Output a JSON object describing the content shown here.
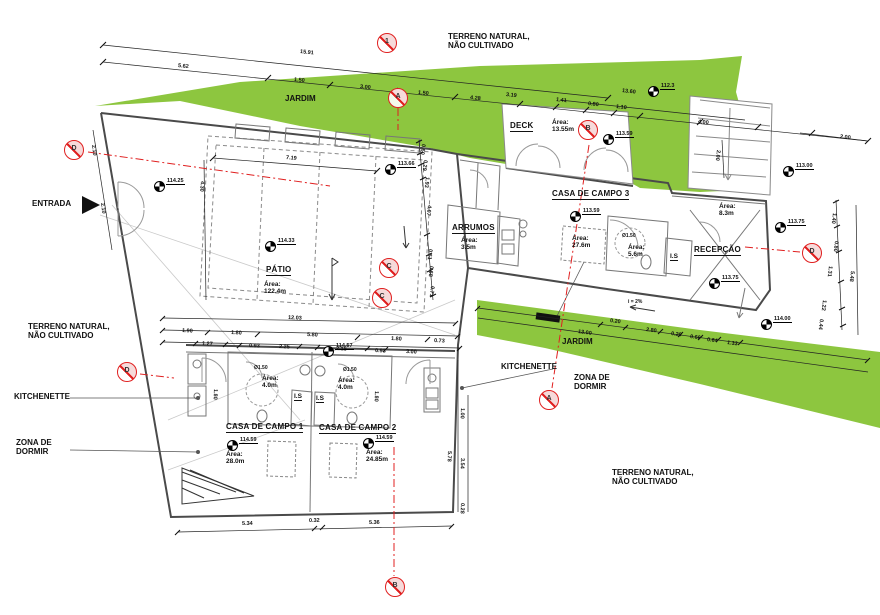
{
  "drawing": {
    "labels": {
      "terrain_top": "TERRENO NATURAL,\nNÃO CULTIVADO",
      "jardim_top": "JARDIM",
      "deck": "DECK",
      "casa3": "CASA DE CAMPO 3",
      "arrumos": "ARRUMOS",
      "recepcao": "RECEPÇÃO",
      "entrada": "ENTRADA",
      "patio": "PÁTIO",
      "terrain_left": "TERRENO NATURAL,\nNÃO CULTIVADO",
      "kitchenette_left": "KITCHENETTE",
      "zona_left": "ZONA DE\nDORMIR",
      "casa1": "CASA DE CAMPO 1",
      "casa2": "CASA DE CAMPO 2",
      "is1": "I.S",
      "is2": "I.S",
      "is3": "I.S",
      "kitchenette_right": "KITCHENETTE",
      "zona_right": "ZONA DE\nDORMIR",
      "jardim_mid": "JARDIM",
      "terrain_bottom": "TERRENO NATURAL,\nNÃO CULTIVADO",
      "slope": "i = 2%"
    },
    "areas": {
      "deck": "Área:\n13.55m",
      "casa3": "Área:\n27.6m",
      "arrumos": "Área:\n3.5m",
      "bath3": "Área:\n5.6m",
      "recepcao": "Área:\n8.3m",
      "patio": "Área:\n122.4m",
      "bath1": "Área:\n4.0m",
      "bath2": "Área:\n4.0m",
      "casa1": "Área:\n28.0m",
      "casa2": "Área:\n24.85m",
      "dia1": "Ø1.50",
      "dia2": "Ø1.50",
      "dia3": "Ø1.50"
    },
    "colors": {
      "green": "#8DC63F",
      "red": "#E02020",
      "wall": "#4A4A4A"
    },
    "elevation_markers": [
      {
        "label": "112.3",
        "x": 648,
        "y": 86
      },
      {
        "label": "113.66",
        "x": 385,
        "y": 164
      },
      {
        "label": "113.59",
        "x": 603,
        "y": 134
      },
      {
        "label": "113.59",
        "x": 570,
        "y": 211
      },
      {
        "label": "113.00",
        "x": 783,
        "y": 166
      },
      {
        "label": "113.75",
        "x": 775,
        "y": 222
      },
      {
        "label": "113.75",
        "x": 709,
        "y": 278
      },
      {
        "label": "114.25",
        "x": 154,
        "y": 181
      },
      {
        "label": "114.33",
        "x": 265,
        "y": 241
      },
      {
        "label": "114.57",
        "x": 323,
        "y": 346
      },
      {
        "label": "114.59",
        "x": 227,
        "y": 440
      },
      {
        "label": "114.59",
        "x": 363,
        "y": 438
      },
      {
        "label": "114.00",
        "x": 761,
        "y": 319
      }
    ],
    "section_markers": [
      {
        "letter": "1",
        "x": 377,
        "y": 33
      },
      {
        "letter": "A",
        "x": 388,
        "y": 88
      },
      {
        "letter": "D",
        "x": 64,
        "y": 140
      },
      {
        "letter": "C",
        "x": 379,
        "y": 258
      },
      {
        "letter": "C",
        "x": 372,
        "y": 288
      },
      {
        "letter": "B",
        "x": 578,
        "y": 120
      },
      {
        "letter": "D",
        "x": 117,
        "y": 362
      },
      {
        "letter": "D",
        "x": 802,
        "y": 243
      },
      {
        "letter": "A",
        "x": 539,
        "y": 390
      },
      {
        "letter": "B",
        "x": 385,
        "y": 577
      }
    ],
    "dim_labels": [
      {
        "v": "15.91",
        "x": 300,
        "y": 49,
        "rot": 6
      },
      {
        "v": "5.62",
        "x": 178,
        "y": 63,
        "rot": 6
      },
      {
        "v": "1.50",
        "x": 294,
        "y": 77,
        "rot": 6
      },
      {
        "v": "3.00",
        "x": 360,
        "y": 84,
        "rot": 6
      },
      {
        "v": "1.50",
        "x": 418,
        "y": 90,
        "rot": 6
      },
      {
        "v": "4.28",
        "x": 470,
        "y": 95,
        "rot": 6
      },
      {
        "v": "3.19",
        "x": 506,
        "y": 92,
        "rot": 6
      },
      {
        "v": "1.41",
        "x": 556,
        "y": 97,
        "rot": 7
      },
      {
        "v": "0.80",
        "x": 588,
        "y": 101,
        "rot": 7
      },
      {
        "v": "1.10",
        "x": 616,
        "y": 104,
        "rot": 7
      },
      {
        "v": "13.60",
        "x": 622,
        "y": 88,
        "rot": 7
      },
      {
        "v": "4.00",
        "x": 698,
        "y": 119,
        "rot": 7
      },
      {
        "v": "2.00",
        "x": 840,
        "y": 134,
        "rot": 7
      },
      {
        "v": "2.00",
        "x": 718,
        "y": 147,
        "rot": 97
      },
      {
        "v": "0.60",
        "x": 423,
        "y": 141,
        "rot": 97
      },
      {
        "v": "0.29",
        "x": 425,
        "y": 157,
        "rot": 97
      },
      {
        "v": "1.93",
        "x": 427,
        "y": 174,
        "rot": 97
      },
      {
        "v": "4.07",
        "x": 429,
        "y": 202,
        "rot": 97
      },
      {
        "v": "0.61",
        "x": 430,
        "y": 246,
        "rot": 97
      },
      {
        "v": "0.68",
        "x": 431,
        "y": 263,
        "rot": 97
      },
      {
        "v": "0.71",
        "x": 432,
        "y": 283,
        "rot": 97
      },
      {
        "v": "7.19",
        "x": 286,
        "y": 155,
        "rot": 5
      },
      {
        "v": "4.30",
        "x": 202,
        "y": 178,
        "rot": 95
      },
      {
        "v": "2.10",
        "x": 93,
        "y": 142,
        "rot": 83
      },
      {
        "v": "2.10",
        "x": 102,
        "y": 200,
        "rot": 83
      },
      {
        "v": "12.03",
        "x": 288,
        "y": 315,
        "rot": 3
      },
      {
        "v": "1.90",
        "x": 182,
        "y": 328,
        "rot": 3
      },
      {
        "v": "1.80",
        "x": 231,
        "y": 330,
        "rot": 3
      },
      {
        "v": "5.80",
        "x": 307,
        "y": 332,
        "rot": 3
      },
      {
        "v": "1.80",
        "x": 391,
        "y": 336,
        "rot": 3
      },
      {
        "v": "0.73",
        "x": 434,
        "y": 338,
        "rot": 3
      },
      {
        "v": "1.27",
        "x": 202,
        "y": 341,
        "rot": 3
      },
      {
        "v": "0.93",
        "x": 249,
        "y": 343,
        "rot": 3
      },
      {
        "v": "2.25",
        "x": 279,
        "y": 344,
        "rot": 3
      },
      {
        "v": "2.15",
        "x": 336,
        "y": 346,
        "rot": 3
      },
      {
        "v": "0.93",
        "x": 375,
        "y": 348,
        "rot": 3
      },
      {
        "v": "3.00",
        "x": 406,
        "y": 349,
        "rot": 3
      },
      {
        "v": "1.80",
        "x": 215,
        "y": 386,
        "rot": 92
      },
      {
        "v": "1.80",
        "x": 376,
        "y": 388,
        "rot": 92
      },
      {
        "v": "5.34",
        "x": 242,
        "y": 521,
        "rot": -1
      },
      {
        "v": "0.32",
        "x": 309,
        "y": 518,
        "rot": -1
      },
      {
        "v": "5.36",
        "x": 369,
        "y": 520,
        "rot": -1
      },
      {
        "v": "5.78",
        "x": 449,
        "y": 448,
        "rot": 92
      },
      {
        "v": "1.00",
        "x": 462,
        "y": 405,
        "rot": 92
      },
      {
        "v": "3.54",
        "x": 462,
        "y": 455,
        "rot": 92
      },
      {
        "v": "0.28",
        "x": 462,
        "y": 500,
        "rot": 92
      },
      {
        "v": "0.20",
        "x": 610,
        "y": 318,
        "rot": 8
      },
      {
        "v": "2.80",
        "x": 646,
        "y": 327,
        "rot": 8
      },
      {
        "v": "0.20",
        "x": 671,
        "y": 331,
        "rot": 8
      },
      {
        "v": "0.66",
        "x": 690,
        "y": 334,
        "rot": 8
      },
      {
        "v": "0.64",
        "x": 707,
        "y": 337,
        "rot": 8
      },
      {
        "v": "1.33",
        "x": 727,
        "y": 340,
        "rot": 8
      },
      {
        "v": "13.00",
        "x": 578,
        "y": 329,
        "rot": 8
      },
      {
        "v": "1.40",
        "x": 834,
        "y": 210,
        "rot": 97
      },
      {
        "v": "0.80",
        "x": 836,
        "y": 238,
        "rot": 97
      },
      {
        "v": "1.31",
        "x": 830,
        "y": 263,
        "rot": 97
      },
      {
        "v": "5.48",
        "x": 852,
        "y": 268,
        "rot": 97
      },
      {
        "v": "1.22",
        "x": 824,
        "y": 297,
        "rot": 97
      },
      {
        "v": "0.44",
        "x": 821,
        "y": 316,
        "rot": 97
      }
    ]
  }
}
